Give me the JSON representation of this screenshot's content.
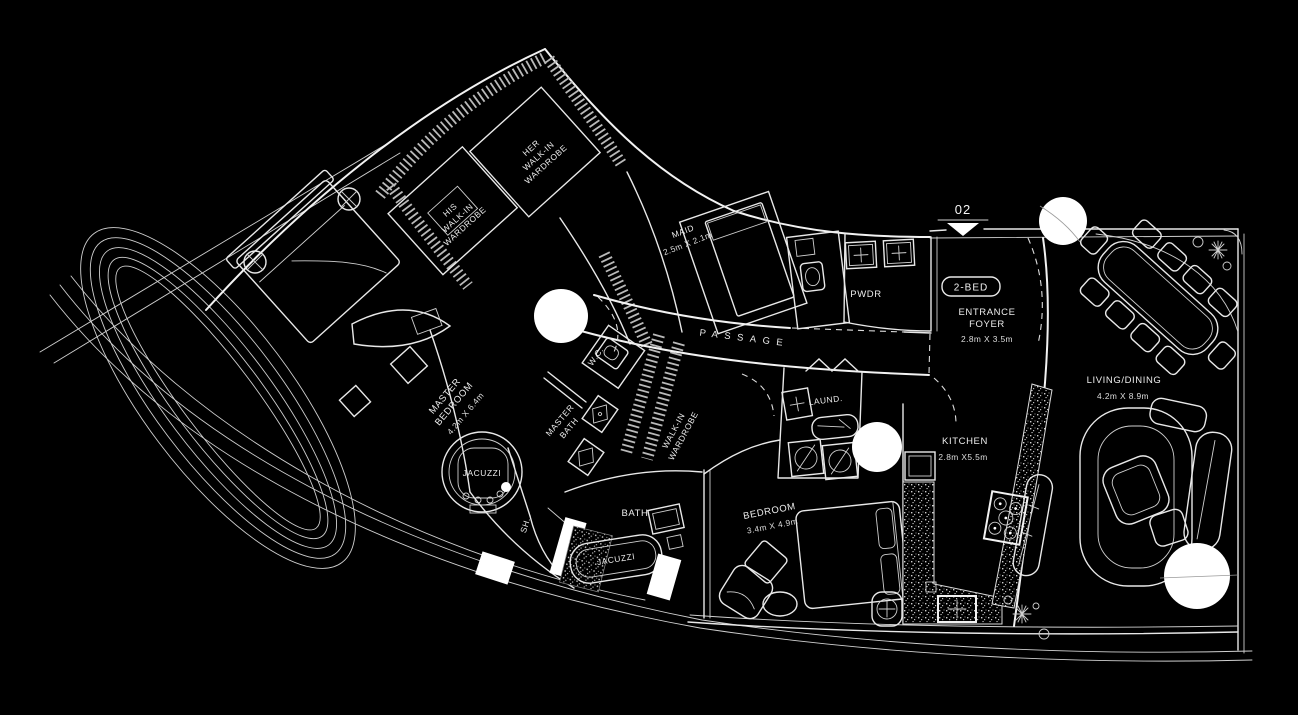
{
  "plan_title": "apartment-floor-plan",
  "colors": {
    "background": "#000000",
    "line": "#ffffff",
    "hatch": "#b9b9b9"
  },
  "unit": {
    "number": "02",
    "type": "2-BED"
  },
  "labels": {
    "master_bedroom": {
      "line1": "MASTER",
      "line2": "BEDROOM",
      "dims": "4.2m X 6.4m"
    },
    "his_wardrobe": {
      "line1": "HIS",
      "line2": "WALK-IN",
      "line3": "WARDROBE"
    },
    "her_wardrobe": {
      "line1": "HER",
      "line2": "WALK-IN",
      "line3": "WARDROBE"
    },
    "maid": {
      "name": "MAID",
      "dims": "2.5m X 2.1m"
    },
    "pwdr": {
      "name": "PWDR"
    },
    "entrance_foyer": {
      "line1": "ENTRANCE",
      "line2": "FOYER",
      "dims": "2.8m X 3.5m"
    },
    "living_dining": {
      "name": "LIVING/DINING",
      "dims": "4.2m X 8.9m"
    },
    "passage": {
      "name": "PASSAGE"
    },
    "wc": {
      "name": "W.C."
    },
    "master_bath": {
      "line1": "MASTER",
      "line2": "BATH"
    },
    "walk_in_wardrobe": {
      "line1": "WALK-IN",
      "line2": "WARDROBE"
    },
    "jacuzzi_master": {
      "name": "JACUZZI"
    },
    "sh": {
      "name": "SH."
    },
    "bath": {
      "name": "BATH"
    },
    "jacuzzi_tub": {
      "name": "JACUZZI"
    },
    "laundry": {
      "name": "LAUND."
    },
    "kitchen": {
      "name": "KITCHEN",
      "dims": "2.8m X5.5m"
    },
    "bedroom": {
      "name": "BEDROOM",
      "dims": "3.4m X 4.9m"
    }
  },
  "icons": {
    "plant-icon": "radiating-star-shrub",
    "column-icon": "circle-with-cross",
    "entry-marker-icon": "filled-triangle",
    "burner-icon": "circle-with-dot"
  }
}
